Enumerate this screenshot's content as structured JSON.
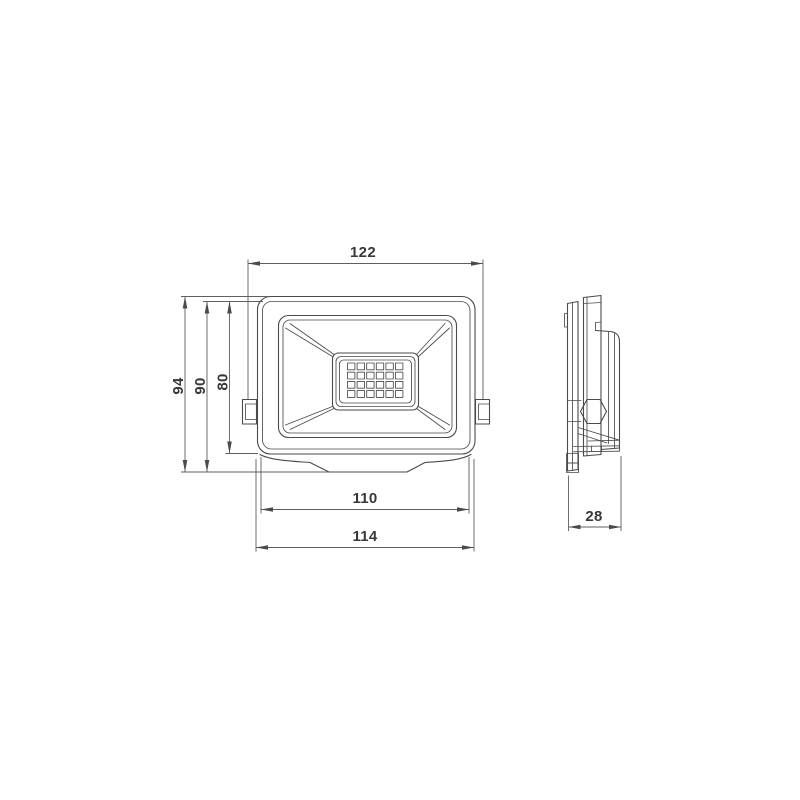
{
  "drawing": {
    "type": "technical-dimension-drawing",
    "subject": "led-floodlight",
    "views": {
      "front": {
        "dims": {
          "top_width": "122",
          "overall_height": "94",
          "body_height": "90",
          "face_height": "80",
          "bottom_width_inner": "110",
          "bottom_width_outer": "114"
        },
        "led_grid": {
          "columns": 6,
          "rows": 4
        }
      },
      "side": {
        "dims": {
          "depth": "28"
        }
      }
    }
  },
  "colors": {
    "background": "#ffffff",
    "line": "#4a4a4a",
    "dim_line": "#5f5f5f",
    "text": "#383838"
  }
}
